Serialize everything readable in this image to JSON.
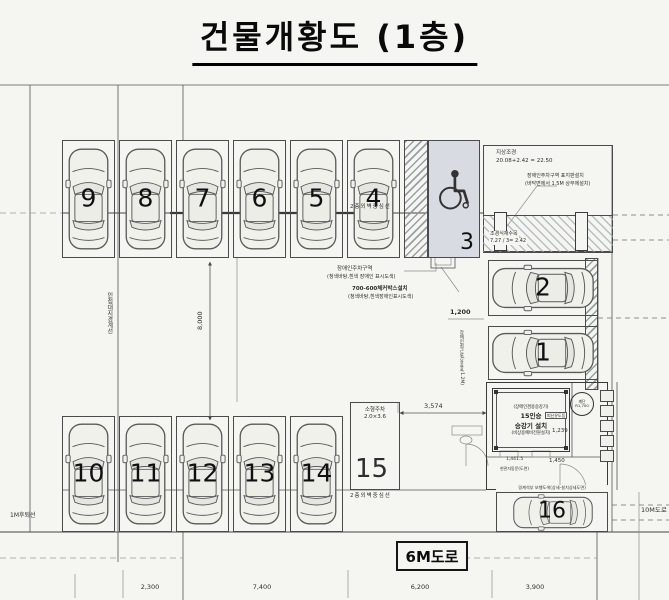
{
  "title": "건물개황도 (1층)",
  "spots": {
    "s1": "1",
    "s2": "2",
    "s3": "3",
    "s4": "4",
    "s5": "5",
    "s6": "6",
    "s7": "7",
    "s8": "8",
    "s9": "9",
    "s10": "10",
    "s11": "11",
    "s12": "12",
    "s13": "13",
    "s14": "14",
    "s15": "15",
    "s16": "16"
  },
  "labels": {
    "landscape_title": "지상조경",
    "landscape_calc": "20.08+2.42 = 22.50",
    "sign_note1": "장애인주차구역 표지판설치",
    "sign_note2": "(바닥면에서 1.5M 상부에설치)",
    "tree_note1": "조경식재수목",
    "tree_note2": "7.27 / 3= 2.42",
    "disabled_note1": "장애인주차구역",
    "disabled_note2": "(청색바탕,흰색 장애인 표시도색)",
    "box_note1": "700-600체커박스설치",
    "box_note2": "(청색바탕,흰색장애인표시도색)",
    "wall_center_top": "2층외벽중심선",
    "wall_center_bottom": "2층외벽중심선",
    "small_parking1": "소형주차",
    "small_parking2": "2.0×3.6",
    "boundary_left": "인접대지경계선",
    "setback": "1M후퇴선",
    "access_note": "장애인접근로(유효폭1.2M)",
    "elev_note1": "(장애인겸용승강기)",
    "elev_note2": "15인승",
    "elev_note3": "승강기 설치",
    "elev_note4": "(비상용예비전원설치)",
    "stair1": "계단",
    "stair2": "R1,700",
    "exit_note": "피난유도등",
    "walk_note": "경계석부 보행도색(상세-설치상세도면)",
    "door_note": "현관자동문(도면)"
  },
  "dims": {
    "d8000": "8,000",
    "d1200": "1,200",
    "d3574": "3,574",
    "d1239": "1,239",
    "d1450": "1,450",
    "d1441": "1,441.5"
  },
  "bottom_dims": [
    "2,300",
    "7,400",
    "6,200",
    "3,900"
  ],
  "roads": {
    "south": "6M도로",
    "east": "10M도로"
  }
}
